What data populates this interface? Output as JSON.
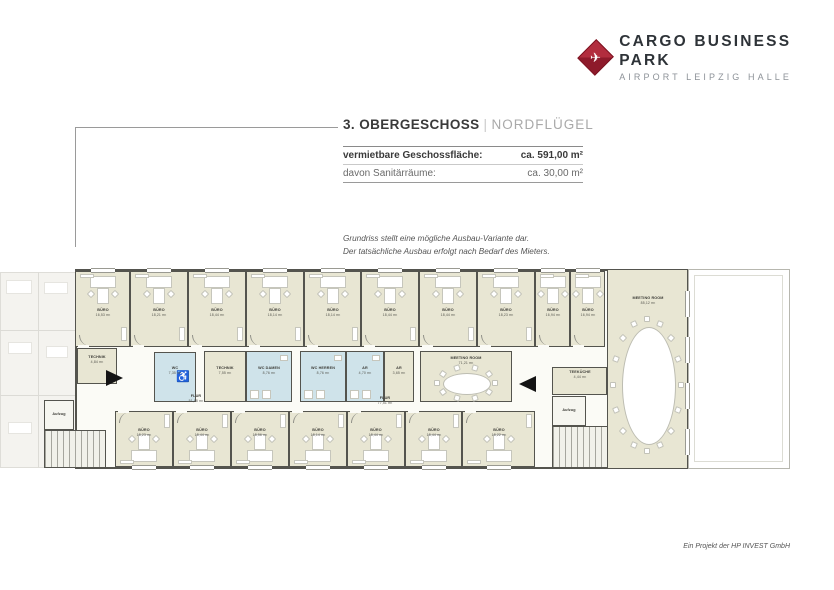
{
  "logo": {
    "brand": "CARGO BUSINESS PARK",
    "sub": "AIRPORT LEIPZIG HALLE",
    "plane_icon": "✈",
    "accent": "#9e1f30"
  },
  "header": {
    "title": "3. OBERGESCHOSS",
    "divider": "|",
    "subtitle": "NORDFLÜGEL"
  },
  "info_table": {
    "rows": [
      {
        "label": "vermietbare Geschossfläche:",
        "value": "ca. 591,00 m²"
      },
      {
        "label": "davon Sanitärräume:",
        "value": "ca. 30,00 m²"
      }
    ]
  },
  "note": {
    "line1": "Grundriss stellt eine mögliche Ausbau-Variante dar.",
    "line2": "Der tatsächliche Ausbau erfolgt nach Bedarf des Mieters."
  },
  "footer": {
    "credit": "Ein Projekt der HP INVEST GmbH"
  },
  "plan": {
    "colors": {
      "wall": "#54544e",
      "room": "#e8e6d3",
      "wet": "#cfe3ea",
      "corridor": "#fbfbf6",
      "faded": "#eceae3"
    },
    "wing": {
      "x": 75,
      "y": 269,
      "w": 613,
      "h": 200
    },
    "top_offices": [
      {
        "label": "BÜRO",
        "area": "16,53 m²",
        "x": 75,
        "w": 55
      },
      {
        "label": "BÜRO",
        "area": "18,21 m²",
        "x": 130,
        "w": 58
      },
      {
        "label": "BÜRO",
        "area": "18,44 m²",
        "x": 188,
        "w": 58
      },
      {
        "label": "BÜRO",
        "area": "18,14 m²",
        "x": 246,
        "w": 58
      },
      {
        "label": "BÜRO",
        "area": "18,14 m²",
        "x": 304,
        "w": 57
      },
      {
        "label": "BÜRO",
        "area": "18,44 m²",
        "x": 361,
        "w": 58
      },
      {
        "label": "BÜRO",
        "area": "18,44 m²",
        "x": 419,
        "w": 58
      },
      {
        "label": "BÜRO",
        "area": "18,23 m²",
        "x": 477,
        "w": 58
      },
      {
        "label": "BÜRO",
        "area": "16,94 m²",
        "x": 535,
        "w": 35
      },
      {
        "label": "BÜRO",
        "area": "16,94 m²",
        "x": 570,
        "w": 35
      }
    ],
    "top_band": {
      "y": 271,
      "h": 76
    },
    "bottom_offices": [
      {
        "label": "BÜRO",
        "area": "18,23 m²",
        "x": 115,
        "w": 58
      },
      {
        "label": "BÜRO",
        "area": "18,44 m²",
        "x": 173,
        "w": 58
      },
      {
        "label": "BÜRO",
        "area": "18,56 m²",
        "x": 231,
        "w": 58
      },
      {
        "label": "BÜRO",
        "area": "18,14 m²",
        "x": 289,
        "w": 58
      },
      {
        "label": "BÜRO",
        "area": "18,44 m²",
        "x": 347,
        "w": 58
      },
      {
        "label": "BÜRO",
        "area": "18,44 m²",
        "x": 405,
        "w": 57
      },
      {
        "label": "BÜRO",
        "area": "18,22 m²",
        "x": 462,
        "w": 73
      }
    ],
    "bottom_band": {
      "y": 411,
      "h": 56
    },
    "mid_rooms": [
      {
        "label": "TECHNIK",
        "area": "4,84 m²",
        "x": 77,
        "y": 348,
        "w": 40,
        "h": 36,
        "fill": "room"
      },
      {
        "label": "WC",
        "area": "7,35 m²",
        "x": 154,
        "y": 352,
        "w": 42,
        "h": 50,
        "fill": "wet",
        "icon": "wheelchair"
      },
      {
        "label": "TECHNIK",
        "area": "7,55 m²",
        "x": 204,
        "y": 351,
        "w": 42,
        "h": 51,
        "fill": "room"
      },
      {
        "label": "WC DAMEN",
        "area": "8,76 m²",
        "x": 246,
        "y": 351,
        "w": 46,
        "h": 51,
        "fill": "wet"
      },
      {
        "label": "WC HERREN",
        "area": "8,76 m²",
        "x": 300,
        "y": 351,
        "w": 46,
        "h": 51,
        "fill": "wet"
      },
      {
        "label": "AR",
        "area": "4,70 m²",
        "x": 346,
        "y": 351,
        "w": 38,
        "h": 51,
        "fill": "wet"
      },
      {
        "label": "AR",
        "area": "3,65 m²",
        "x": 384,
        "y": 351,
        "w": 30,
        "h": 51,
        "fill": "room"
      },
      {
        "label": "MEETING ROOM",
        "area": "71,21 m²",
        "x": 420,
        "y": 351,
        "w": 92,
        "h": 51,
        "fill": "room",
        "table": "oval-h"
      },
      {
        "label": "TEEKÜCHE",
        "area": "4,44 m²",
        "x": 552,
        "y": 367,
        "w": 55,
        "h": 28,
        "fill": "room"
      }
    ],
    "corridors": [
      {
        "label": "FLUR",
        "area": "51,98 m²",
        "cx": 196,
        "cy": 399
      },
      {
        "label": "FLUR",
        "area": "77,51 m²",
        "cx": 385,
        "cy": 401
      }
    ],
    "big_meeting": {
      "label": "MEETING ROOM",
      "area": "85,12 m²",
      "x": 607,
      "y": 269,
      "w": 81,
      "h": 200
    },
    "terrace": {
      "x": 688,
      "y": 269,
      "w": 102,
      "h": 200
    },
    "elevators": [
      {
        "label": "Aufzug",
        "x": 44,
        "y": 400,
        "w": 30,
        "h": 30
      },
      {
        "label": "Aufzug",
        "x": 552,
        "y": 396,
        "w": 34,
        "h": 30
      }
    ],
    "stairs": [
      {
        "x": 44,
        "y": 430,
        "w": 62,
        "h": 38
      },
      {
        "x": 552,
        "y": 426,
        "w": 56,
        "h": 42
      }
    ],
    "arrows": [
      {
        "x": 106,
        "y": 370,
        "dir": "right"
      },
      {
        "x": 519,
        "y": 376,
        "dir": "left"
      }
    ],
    "wheelchair_icon": "♿"
  }
}
